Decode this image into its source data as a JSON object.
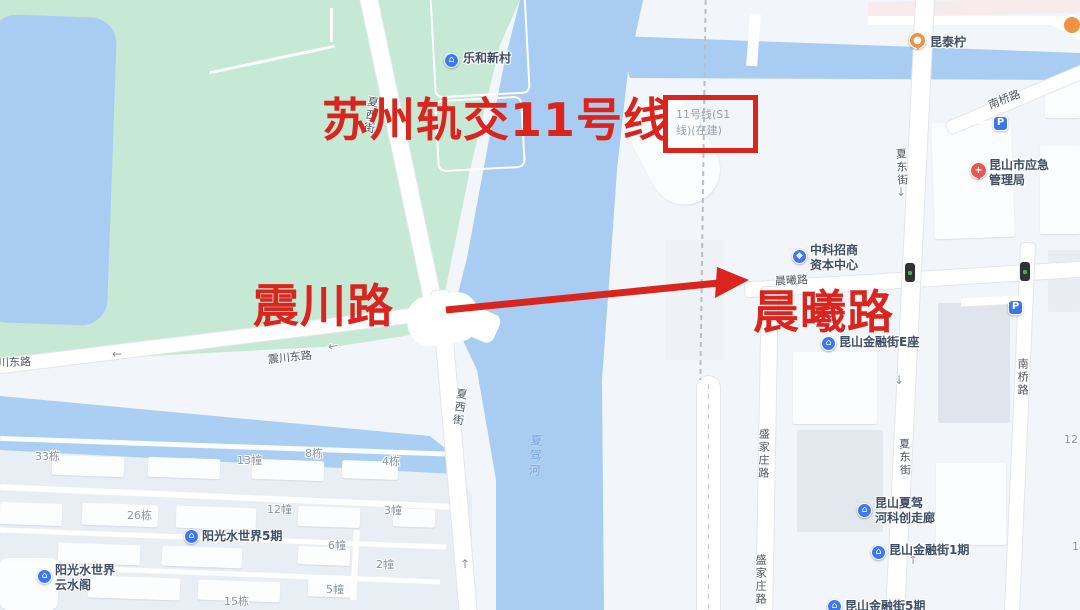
{
  "annotations": {
    "metro_line_label": "苏州轨交11号线",
    "construction_box_text": "11号线(S1\n线)(在建)",
    "road_annotation_left": "震川路",
    "road_annotation_right": "晨曦路",
    "accent_color": "#d9251d"
  },
  "road_labels": {
    "zhenchuan_east_partial": "震川东路",
    "zhenchuan_east": "震川东路",
    "xiaxi_street_upper": "夏西街",
    "xiaxi_street_lower": "夏西街",
    "xiadong_street_upper": "夏东街",
    "xiadong_street_lower": "夏东街",
    "nanqiao_road_upper": "南桥路",
    "nanqiao_road_lower": "南桥路",
    "shengjiazhuang_road_upper": "盛家庄路",
    "shengjiazhuang_road_lower": "盛家庄路",
    "chenxi_road_small": "晨曦路"
  },
  "water_labels": {
    "river": "夏驾河"
  },
  "pois": [
    {
      "name": "乐和新村",
      "glyph": "⌂"
    },
    {
      "name": "中科招商\n资本中心",
      "glyph": "◆"
    },
    {
      "name": "昆泰柠",
      "glyph": "●"
    },
    {
      "name": "昆山市应急\n管理局",
      "glyph": "+"
    },
    {
      "name": "昆山金融街E座",
      "glyph": "⌂"
    },
    {
      "name": "阳光水世界5期",
      "glyph": "⌂"
    },
    {
      "name": "阳光水世界\n云水阁",
      "glyph": "⌂"
    },
    {
      "name": "昆山夏驾\n河科创走廊",
      "glyph": "⌂"
    },
    {
      "name": "昆山金融街1期",
      "glyph": "⌂"
    },
    {
      "name": "昆山金融街5期",
      "glyph": "⌂"
    }
  ],
  "building_numbers": [
    "33栋",
    "13幢",
    "8栋",
    "4栋",
    "26栋",
    "12幢",
    "3幢",
    "6幢",
    "2幢",
    "5幢",
    "15栋",
    "12",
    "1"
  ],
  "icons": {
    "arrow_left": "←",
    "arrow_up": "↑",
    "arrow_down": "↓",
    "parking": "P"
  },
  "map_colors": {
    "park": "#c6e9d6",
    "water": "#a9cdf2",
    "city_background": "#f2f5f9",
    "block": "#e3e8ef",
    "road": "#ffffff",
    "poi_blue": "#3c79ec",
    "poi_orange": "#f0923f",
    "emergency_red": "#e8564e",
    "annotation_red": "#d9251d"
  }
}
